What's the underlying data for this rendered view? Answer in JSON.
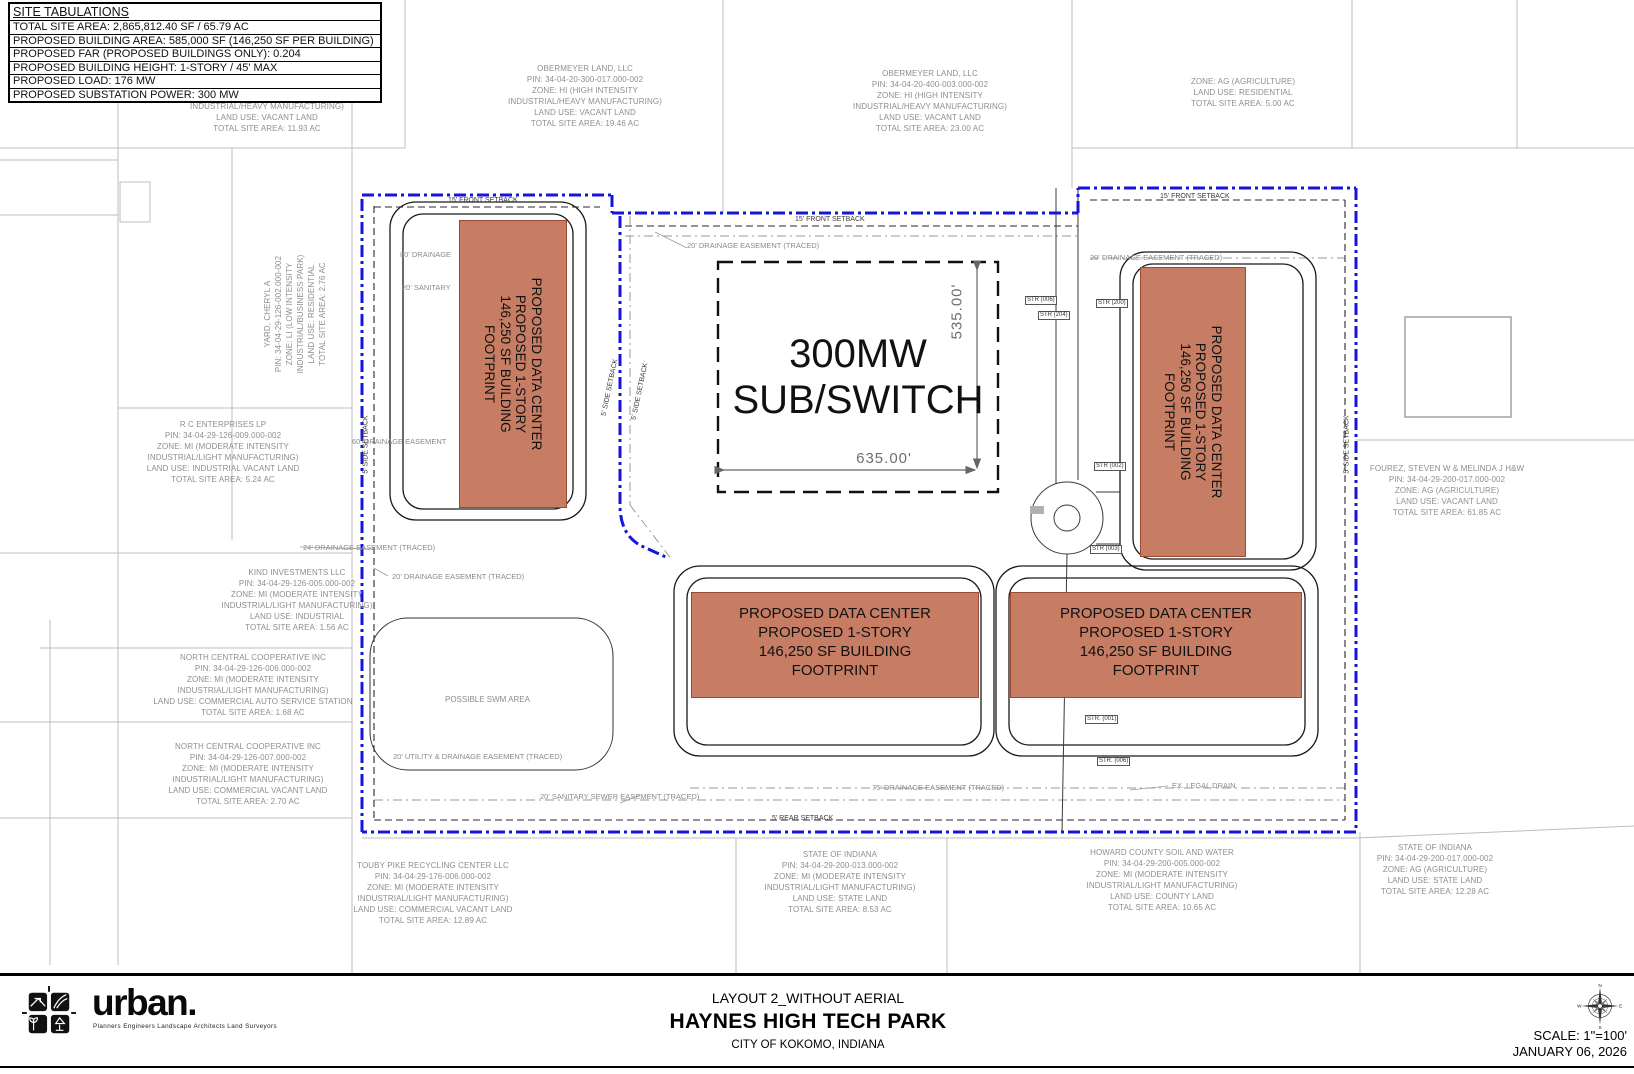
{
  "site_tabulations": {
    "title": "SITE TABULATIONS",
    "rows": [
      "TOTAL SITE AREA: 2,865,812.40 SF / 65.79 AC",
      "PROPOSED BUILDING AREA: 585,000 SF (146,250 SF PER BUILDING)",
      "PROPOSED FAR (PROPOSED BUILDINGS ONLY): 0.204",
      "PROPOSED BUILDING HEIGHT: 1-STORY / 45' MAX",
      "PROPOSED LOAD: 176 MW",
      "PROPOSED SUBSTATION POWER: 300 MW"
    ]
  },
  "parcels": [
    {
      "id": "parcel-partial-top-left",
      "lines": [
        "INDUSTRIAL/HEAVY MANUFACTURING)",
        "LAND USE: VACANT LAND",
        "TOTAL SITE AREA: 11.93 AC"
      ]
    },
    {
      "id": "parcel-obermeyer-west",
      "lines": [
        "OBERMEYER LAND, LLC",
        "PIN: 34-04-20-300-017.000-002",
        "ZONE: HI (HIGH INTENSITY",
        "INDUSTRIAL/HEAVY MANUFACTURING)",
        "LAND USE: VACANT LAND",
        "TOTAL SITE AREA: 19.46 AC"
      ]
    },
    {
      "id": "parcel-obermeyer-east",
      "lines": [
        "OBERMEYER LAND, LLC",
        "PIN: 34-04-20-400-003.000-002",
        "ZONE: HI (HIGH INTENSITY",
        "INDUSTRIAL/HEAVY MANUFACTURING)",
        "LAND USE: VACANT LAND",
        "TOTAL SITE AREA: 23.00 AC"
      ]
    },
    {
      "id": "parcel-ag-residential",
      "lines": [
        "ZONE: AG (AGRICULTURE)",
        "LAND USE: RESIDENTIAL",
        "TOTAL SITE AREA: 5.00 AC"
      ]
    },
    {
      "id": "parcel-yard-cheryl",
      "lines": [
        "YARD, CHERYL A",
        "PIN: 34-04-29-126-002.000-002",
        "ZONE: LI (LOW INTENSITY",
        "INDUSTRIAL/BUSINESS PARK)",
        "LAND USE: RESIDENTIAL",
        "TOTAL SITE AREA: 2.76 AC"
      ]
    },
    {
      "id": "parcel-rc-enterprises",
      "lines": [
        "R C ENTERPRISES LP",
        "PIN: 34-04-29-126-009.000-002",
        "ZONE: MI (MODERATE INTENSITY",
        "INDUSTRIAL/LIGHT MANUFACTURING)",
        "LAND USE: INDUSTRIAL VACANT LAND",
        "TOTAL SITE AREA: 5.24 AC"
      ]
    },
    {
      "id": "parcel-kind-investments",
      "lines": [
        "KIND INVESTMENTS LLC",
        "PIN: 34-04-29-126-005.000-002",
        "ZONE: MI (MODERATE INTENSITY",
        "INDUSTRIAL/LIGHT MANUFACTURING)",
        "LAND USE: INDUSTRIAL",
        "TOTAL SITE AREA: 1.56 AC"
      ]
    },
    {
      "id": "parcel-ncc-north",
      "lines": [
        "NORTH CENTRAL COOPERATIVE INC",
        "PIN: 34-04-29-126-006.000-002",
        "ZONE: MI (MODERATE INTENSITY",
        "INDUSTRIAL/LIGHT MANUFACTURING)",
        "LAND USE: COMMERCIAL AUTO SERVICE STATION",
        "TOTAL SITE AREA: 1.68 AC"
      ]
    },
    {
      "id": "parcel-ncc-south",
      "lines": [
        "NORTH CENTRAL COOPERATIVE INC",
        "PIN: 34-04-29-126-007.000-002",
        "ZONE: MI (MODERATE INTENSITY",
        "INDUSTRIAL/LIGHT MANUFACTURING)",
        "LAND USE: COMMERCIAL VACANT LAND",
        "TOTAL SITE AREA: 2.70 AC"
      ]
    },
    {
      "id": "parcel-touby-pike",
      "lines": [
        "TOUBY PIKE RECYCLING CENTER LLC",
        "PIN: 34-04-29-176-006.000-002",
        "ZONE: MI (MODERATE INTENSITY",
        "INDUSTRIAL/LIGHT MANUFACTURING)",
        "LAND USE: COMMERCIAL VACANT LAND",
        "TOTAL SITE AREA: 12.89 AC"
      ]
    },
    {
      "id": "parcel-state-indiana-south",
      "lines": [
        "STATE OF INDIANA",
        "PIN: 34-04-29-200-013.000-002",
        "ZONE: MI (MODERATE INTENSITY",
        "INDUSTRIAL/LIGHT MANUFACTURING)",
        "LAND USE: STATE LAND",
        "TOTAL SITE AREA: 8.53 AC"
      ]
    },
    {
      "id": "parcel-howard-county",
      "lines": [
        "HOWARD COUNTY SOIL AND WATER",
        "PIN: 34-04-29-200-005.000-002",
        "ZONE: MI (MODERATE INTENSITY",
        "INDUSTRIAL/LIGHT MANUFACTURING)",
        "LAND USE: COUNTY LAND",
        "TOTAL SITE AREA: 10.65 AC"
      ]
    },
    {
      "id": "parcel-state-indiana-east",
      "lines": [
        "STATE OF INDIANA",
        "PIN: 34-04-29-200-017.000-002",
        "ZONE: AG (AGRICULTURE)",
        "LAND USE: STATE LAND",
        "TOTAL SITE AREA: 12.28 AC"
      ]
    },
    {
      "id": "parcel-fourez",
      "lines": [
        "FOUREZ, STEVEN W & MELINDA J H&W",
        "PIN: 34-04-29-200-017.000-002",
        "ZONE: AG (AGRICULTURE)",
        "LAND USE: VACANT LAND",
        "TOTAL SITE AREA: 61.85 AC"
      ]
    }
  ],
  "building_label": {
    "lines": [
      "PROPOSED DATA CENTER",
      "PROPOSED 1-STORY",
      "146,250 SF BUILDING",
      "FOOTPRINT"
    ]
  },
  "substation": {
    "line1": "300MW",
    "line2": "SUB/SWITCH",
    "dim_height": "535.00'",
    "dim_width": "635.00'"
  },
  "annotations": [
    {
      "text": "15' FRONT SETBACK"
    },
    {
      "text": "20' DRAINAGE EASEMENT (TRACED)"
    },
    {
      "text": "15' FRONT SETBACK"
    },
    {
      "text": "15' FRONT SETBACK"
    },
    {
      "text": "20' DRAINAGE EASEMENT (TRACED)"
    },
    {
      "text": "80' DRAINAGE"
    },
    {
      "text": "20' SANITARY"
    },
    {
      "text": "60' DRAINAGE EASEMENT"
    },
    {
      "text": "24' DRAINAGE EASEMENT (TRACED)"
    },
    {
      "text": "20' DRAINAGE EASEMENT (TRACED)"
    },
    {
      "text": "5' SIDE SETBACK"
    },
    {
      "text": "5' SIDE SETBACK"
    },
    {
      "text": "5' SIDE SETBACK"
    },
    {
      "text": "5' SIDE SETBACK"
    },
    {
      "text": "POSSIBLE SWM AREA"
    },
    {
      "text": "20' UTILITY & DRAINAGE EASEMENT (TRACED)"
    },
    {
      "text": "20' SANITARY SEWER EASEMENT (TRACED)"
    },
    {
      "text": "5' REAR SETBACK"
    },
    {
      "text": "75' DRAINAGE EASEMENT (TRACED)"
    },
    {
      "text": "EX. LEGAL DRAIN"
    }
  ],
  "structures": [
    {
      "label": "STR (006)"
    },
    {
      "label": "STR (200)"
    },
    {
      "label": "STR (204)"
    },
    {
      "label": "STR (002)"
    },
    {
      "label": "STR (003)"
    },
    {
      "label": "STR. (001)"
    },
    {
      "label": "STR. (006)"
    }
  ],
  "title_block": {
    "layout": "LAYOUT 2_WITHOUT AERIAL",
    "project": "HAYNES HIGH TECH PARK",
    "city": "CITY OF KOKOMO, INDIANA",
    "scale": "SCALE: 1\"=100'",
    "date": "JANUARY 06, 2026",
    "firm": "urban.",
    "firm_tagline": "Planners  Engineers  Landscape Architects  Land Surveyors",
    "compass": {
      "n": "N",
      "s": "S",
      "e": "E",
      "w": "W"
    }
  },
  "colors": {
    "boundary_blue": "#1414e0",
    "building_fill": "#c67d64",
    "building_stroke": "#9c4a36"
  }
}
